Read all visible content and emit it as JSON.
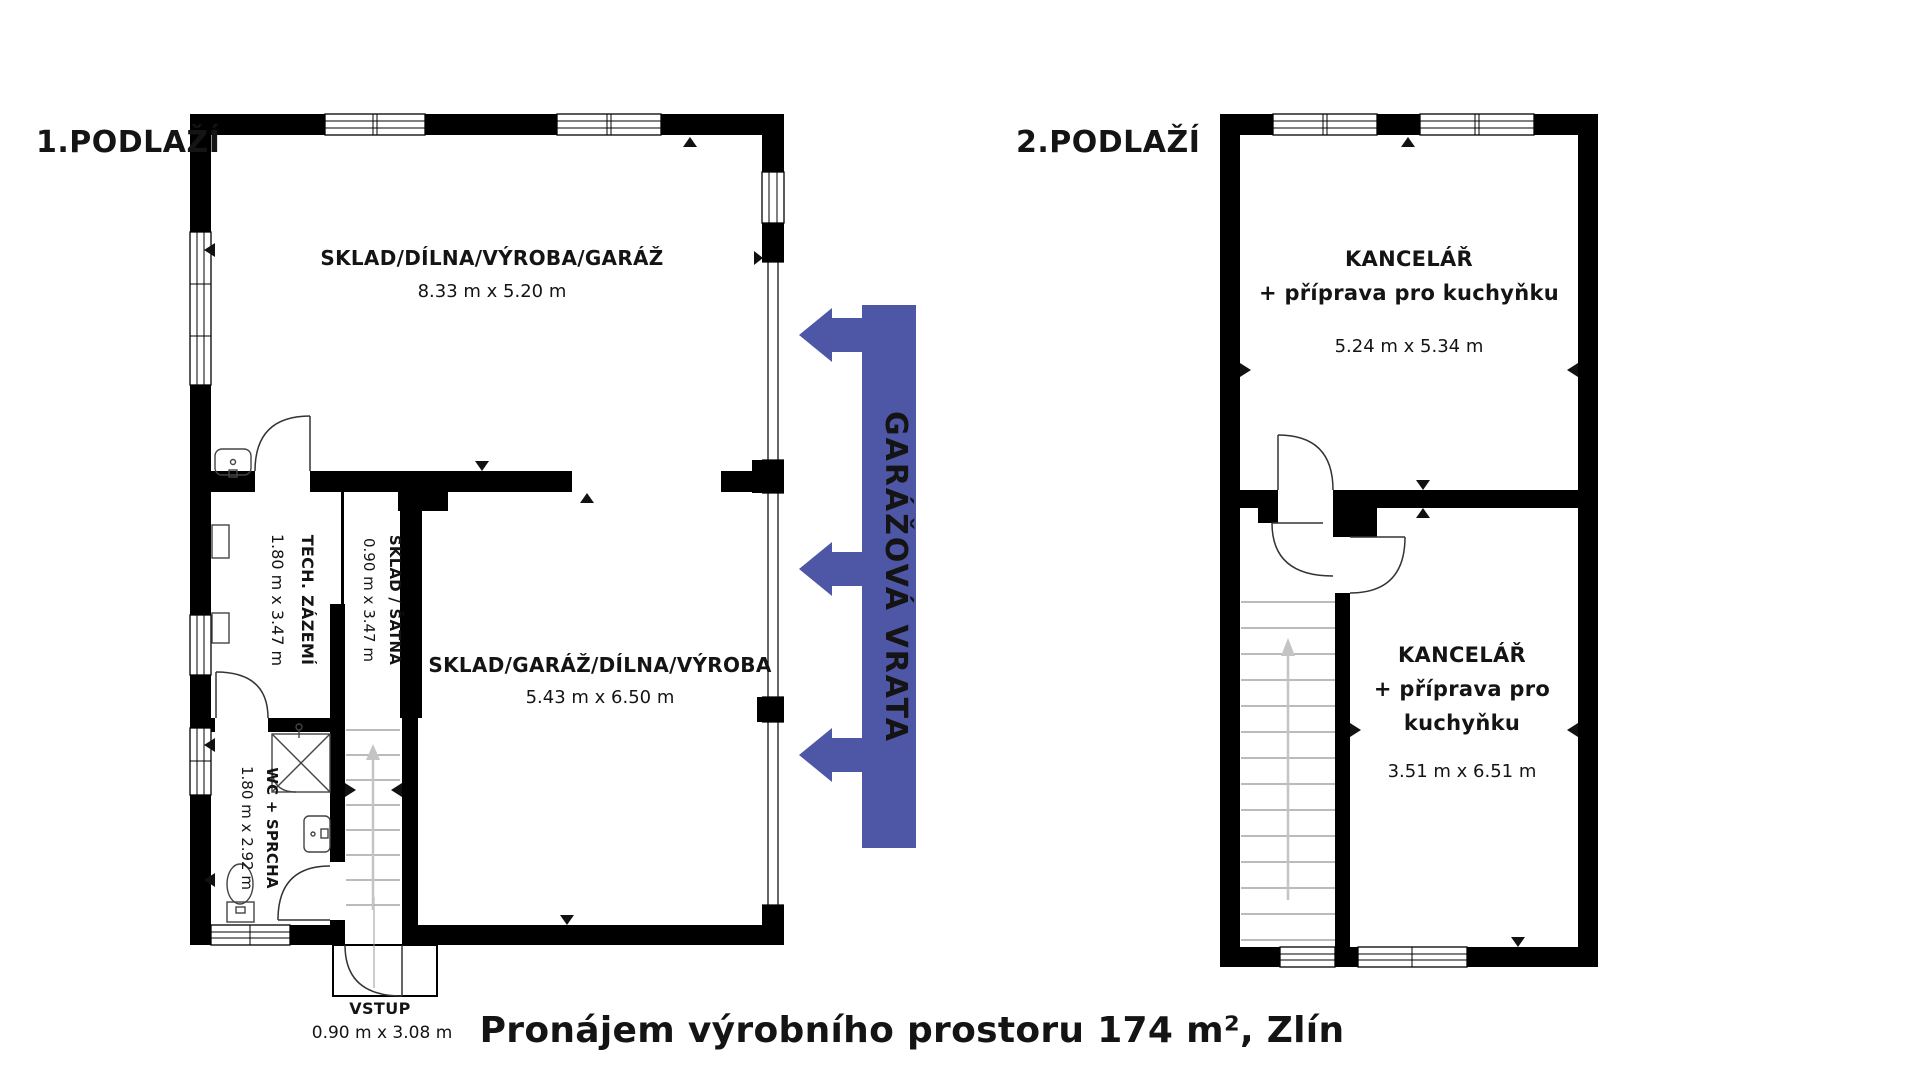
{
  "title": {
    "text": "Pronájem výrobního prostoru 174 m², Zlín"
  },
  "floor1": {
    "label": "1.PODLAŽÍ",
    "room_storage_top": {
      "name": "SKLAD/DÍLNA/VÝROBA/GARÁŽ",
      "dims": "8.33 m x 5.20 m"
    },
    "room_storage_main": {
      "name": "SKLAD/GARÁŽ/DÍLNA/VÝROBA",
      "dims": "5.43 m x 6.50 m"
    },
    "room_tech": {
      "name": "TECH. ZÁZEMÍ",
      "dims": "1.80 m x 3.47 m"
    },
    "room_satna": {
      "name": "SKLAD / ŠATNA",
      "dims": "0.90 m x 3.47 m"
    },
    "room_wc": {
      "name": "WC + SPRCHA",
      "dims": "1.80 m x 2.92 m"
    },
    "entrance": {
      "name": "VSTUP",
      "dims": "0.90 m x 3.08 m"
    }
  },
  "floor2": {
    "label": "2.PODLAŽÍ",
    "room_office_top": {
      "name": "KANCELÁŘ",
      "line2": "+ příprava pro kuchyňku",
      "dims": "5.24 m x 5.34 m"
    },
    "room_office_bottom": {
      "name": "KANCELÁŘ",
      "line2": "+ příprava pro",
      "line3": "kuchyňku",
      "dims": "3.51 m x 6.51 m"
    }
  },
  "banner": {
    "label": "GARÁŽOVÁ VRATA",
    "color": "#4e57a6",
    "text_color": "#1b2050"
  }
}
